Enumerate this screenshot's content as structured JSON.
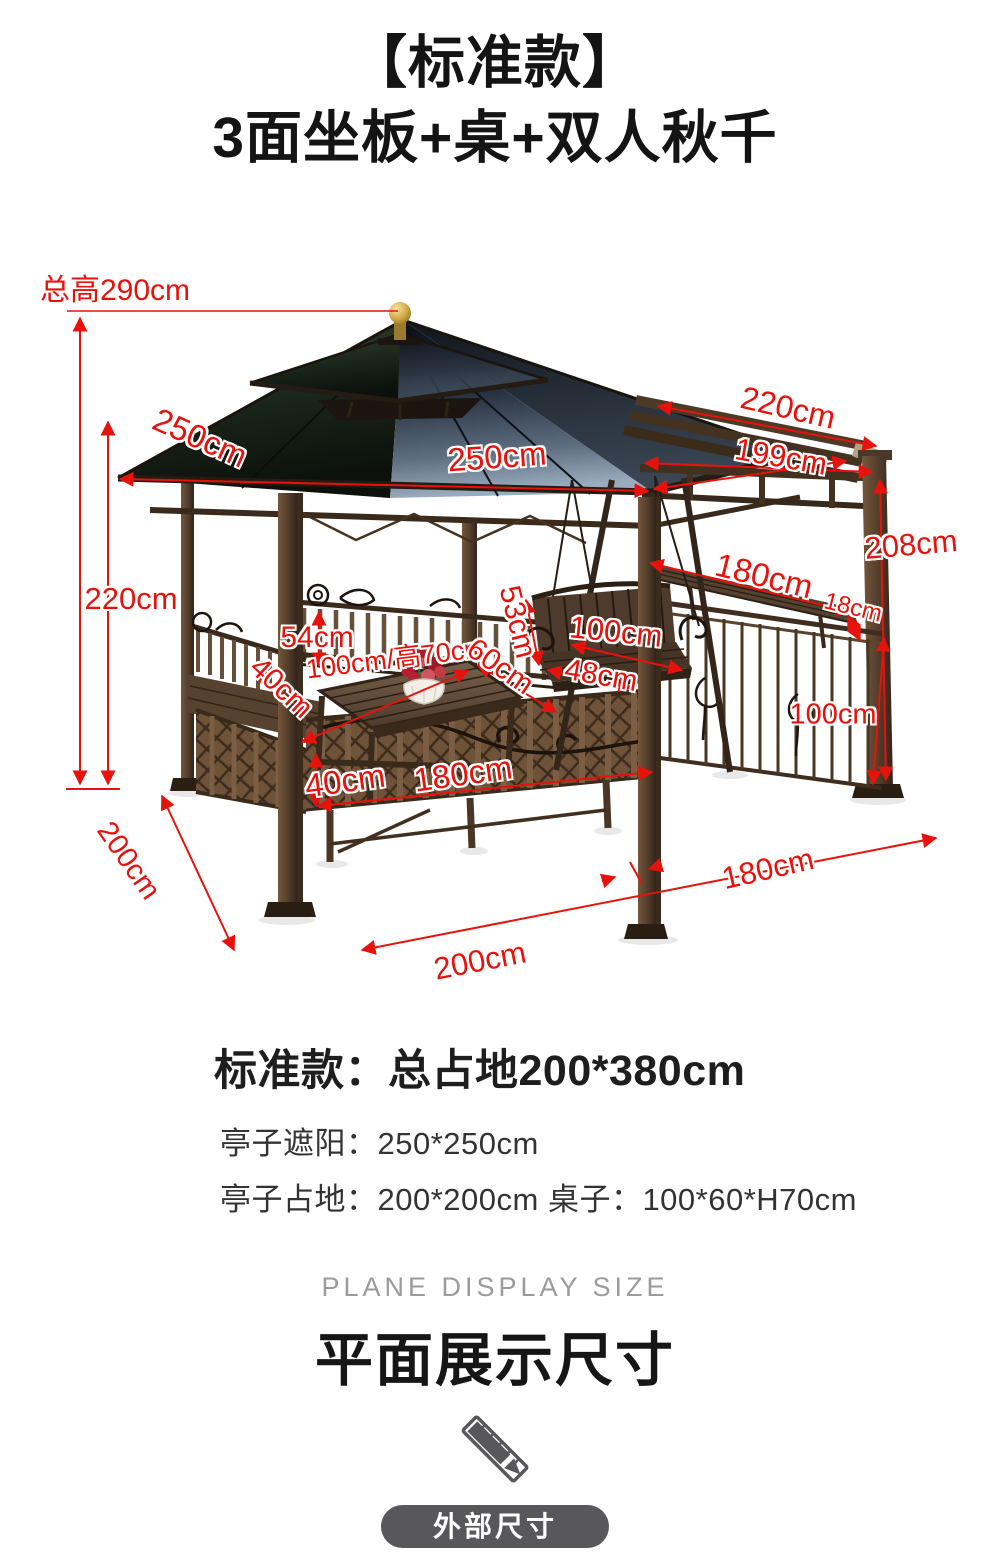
{
  "title": {
    "line1": "【标准款】",
    "line2": "3面坐板+桌+双人秋千"
  },
  "figure": {
    "description": "gazebo-with-double-swing-dimension-photo",
    "labels": [
      {
        "id": "total-height",
        "text": "总高290cm"
      },
      {
        "id": "roof-left-side",
        "text": "250cm"
      },
      {
        "id": "roof-front-side",
        "text": "250cm"
      },
      {
        "id": "pergola-top-length",
        "text": "220cm"
      },
      {
        "id": "pergola-beam-length",
        "text": "199cm"
      },
      {
        "id": "right-post-height",
        "text": "208cm"
      },
      {
        "id": "side-bench-length",
        "text": "180cm"
      },
      {
        "id": "side-bench-depth",
        "text": "18cm"
      },
      {
        "id": "post-height",
        "text": "220cm"
      },
      {
        "id": "backrest-height",
        "text": "54cm"
      },
      {
        "id": "table-size",
        "text": "100cm/高70cm"
      },
      {
        "id": "table-depth",
        "text": "60cm"
      },
      {
        "id": "swing-back-height",
        "text": "53cm"
      },
      {
        "id": "swing-seat-width",
        "text": "100cm"
      },
      {
        "id": "swing-seat-depth",
        "text": "48cm"
      },
      {
        "id": "left-bench-depth",
        "text": "40cm"
      },
      {
        "id": "fence-height",
        "text": "100cm"
      },
      {
        "id": "front-bench-height",
        "text": "40cm"
      },
      {
        "id": "front-bench-length",
        "text": "180cm"
      },
      {
        "id": "ground-depth",
        "text": "200cm"
      },
      {
        "id": "ground-width",
        "text": "200cm"
      },
      {
        "id": "ground-extension",
        "text": "180cm"
      }
    ]
  },
  "specs": {
    "heading": "标准款：总占地200*380cm",
    "line1": "亭子遮阳：250*250cm",
    "line2": "亭子占地：200*200cm 桌子：100*60*H70cm"
  },
  "footer": {
    "subtitle_en": "PLANE DISPLAY SIZE",
    "title_cn": "平面展示尺寸",
    "badge": "外部尺寸"
  },
  "colors": {
    "annotation": "#e8120c",
    "badge_bg": "#58585a"
  }
}
